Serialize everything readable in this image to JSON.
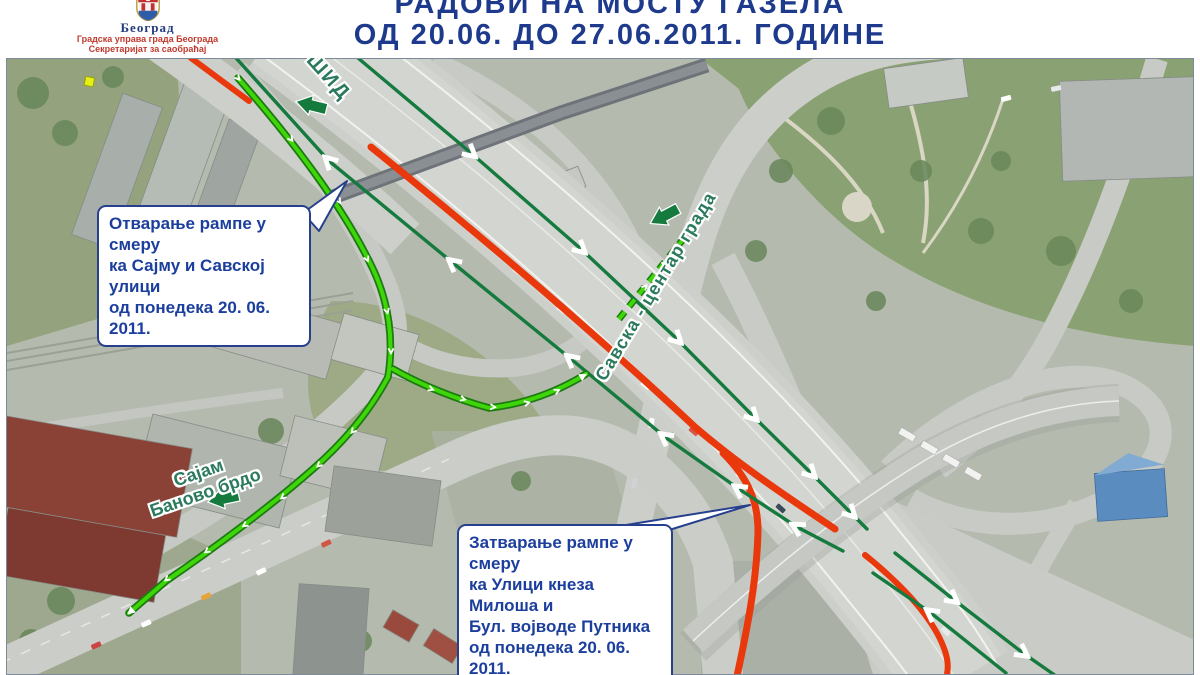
{
  "header": {
    "city_name": "Београд",
    "org_line1": "Градска управа града Београда",
    "org_line2": "Секретаријат за саобраћај",
    "title_line1": "РАДОВИ НА МОСТУ ГАЗЕЛА",
    "title_line2": "ОД 20.06. ДО 27.06.2011. ГОДИНЕ"
  },
  "map": {
    "labels": {
      "sid": "ШИД",
      "savska": "Савска - центар града",
      "sajam_line1": "Сајам",
      "sajam_line2": "Баново брдо"
    },
    "callouts": {
      "open_ramp": {
        "lines": [
          "Отварање рампе у смеру",
          "ка Сајму и Савској улици",
          "од понедека 20. 06. 2011."
        ]
      },
      "closed_ramp": {
        "lines": [
          "Затварање рампе у смеру",
          "ка Улици кнеза Милоша и",
          "Бул. војводе Путника",
          "од понедека 20. 06. 2011."
        ]
      }
    }
  },
  "colors": {
    "title_blue": "#1e3a8c",
    "org_red": "#c03a2e",
    "callout_blue": "#1c3f9e",
    "callout_border": "#27408e",
    "label_green": "#2b7a5e",
    "closed_route_red": "#e8380c",
    "open_route_dark_green": "#157a3e",
    "open_route_bright_green": "#3fd609",
    "open_route_casing": "#1c7a12"
  }
}
